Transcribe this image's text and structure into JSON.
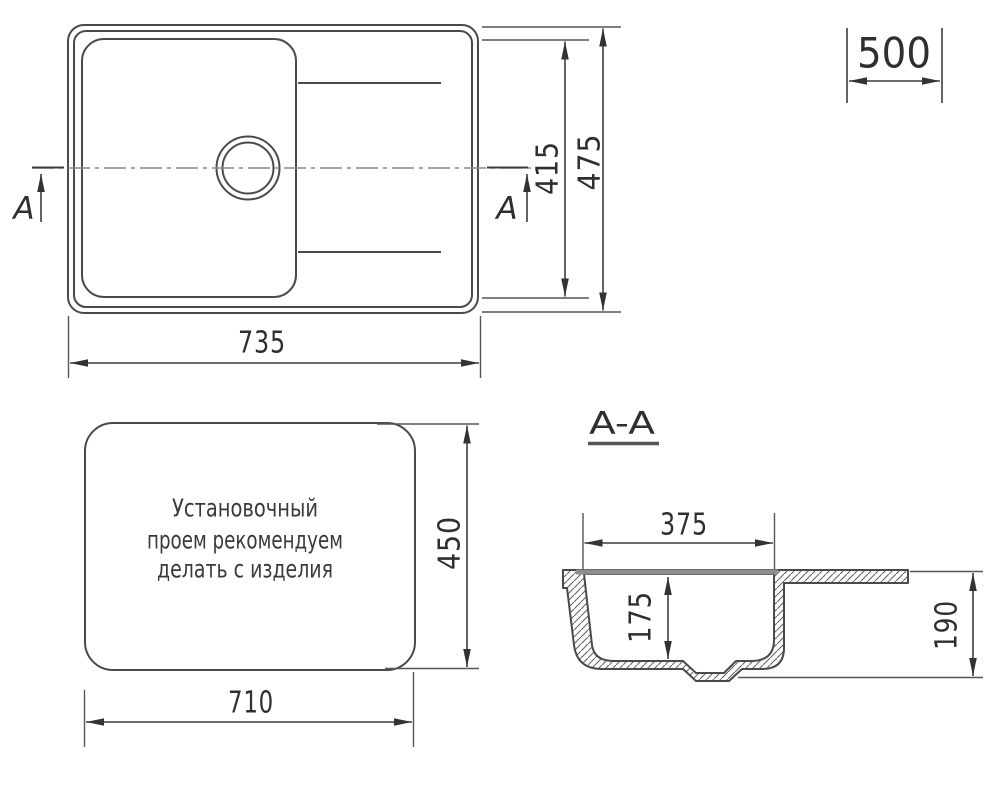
{
  "colors": {
    "line": "#4a4a4a",
    "text": "#2f2f2f",
    "gray_rim_bar": "#8e8e8e",
    "background": "#ffffff"
  },
  "top_view": {
    "dim_width": "735",
    "dim_inner_height": "415",
    "dim_outer_height": "475",
    "dim_cabinet_width": "500",
    "section_label_left": "A",
    "section_label_right": "A"
  },
  "cutout_view": {
    "note_line1": "Установочный",
    "note_line2": "проем рекомендуем",
    "note_line3": "делать с изделия",
    "dim_width": "710",
    "dim_height": "450"
  },
  "section_view": {
    "title": "A-A",
    "dim_bowl_width": "375",
    "dim_bowl_depth": "175",
    "dim_total_depth": "190"
  }
}
